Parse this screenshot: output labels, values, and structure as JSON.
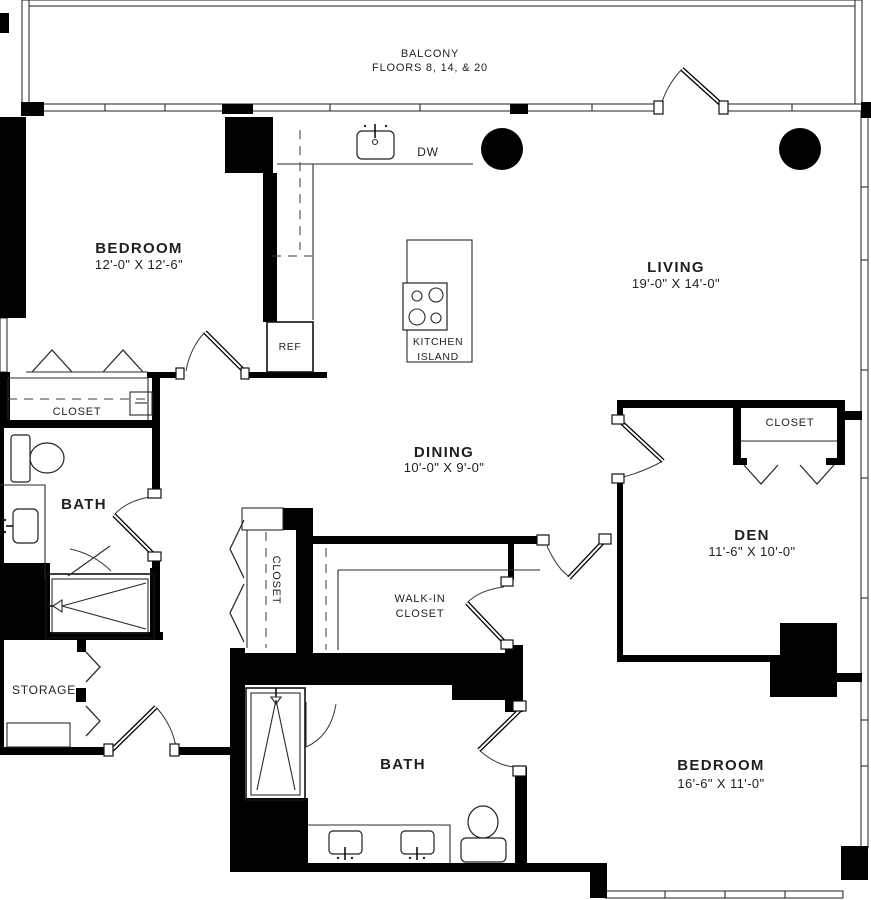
{
  "colors": {
    "wall": "#000000",
    "line": "#2a2a2a",
    "text": "#1f1f1f",
    "background": "#ffffff"
  },
  "balcony": {
    "title": "BALCONY",
    "subtitle": "FLOORS 8, 14, & 20"
  },
  "rooms": {
    "bedroom_top": {
      "name": "BEDROOM",
      "dims": "12'-0\" X 12'-6\""
    },
    "living": {
      "name": "LIVING",
      "dims": "19'-0\" X 14'-0\""
    },
    "dining": {
      "name": "DINING",
      "dims": "10'-0\" X 9'-0\""
    },
    "den": {
      "name": "DEN",
      "dims": "11'-6\" X 10'-0\""
    },
    "bedroom_bottom": {
      "name": "BEDROOM",
      "dims": "16'-6\" X 11'-0\""
    },
    "bath_top": {
      "name": "BATH"
    },
    "bath_bottom": {
      "name": "BATH"
    },
    "storage": {
      "name": "STORAGE"
    },
    "walk_in_closet": {
      "line1": "WALK-IN",
      "line2": "CLOSET"
    }
  },
  "closets": {
    "bedroom_closet": "CLOSET",
    "hall_closet": "CLOSET",
    "den_closet": "CLOSET"
  },
  "kitchen": {
    "island_line1": "KITCHEN",
    "island_line2": "ISLAND",
    "refrigerator": "REF",
    "dishwasher": "DW"
  }
}
